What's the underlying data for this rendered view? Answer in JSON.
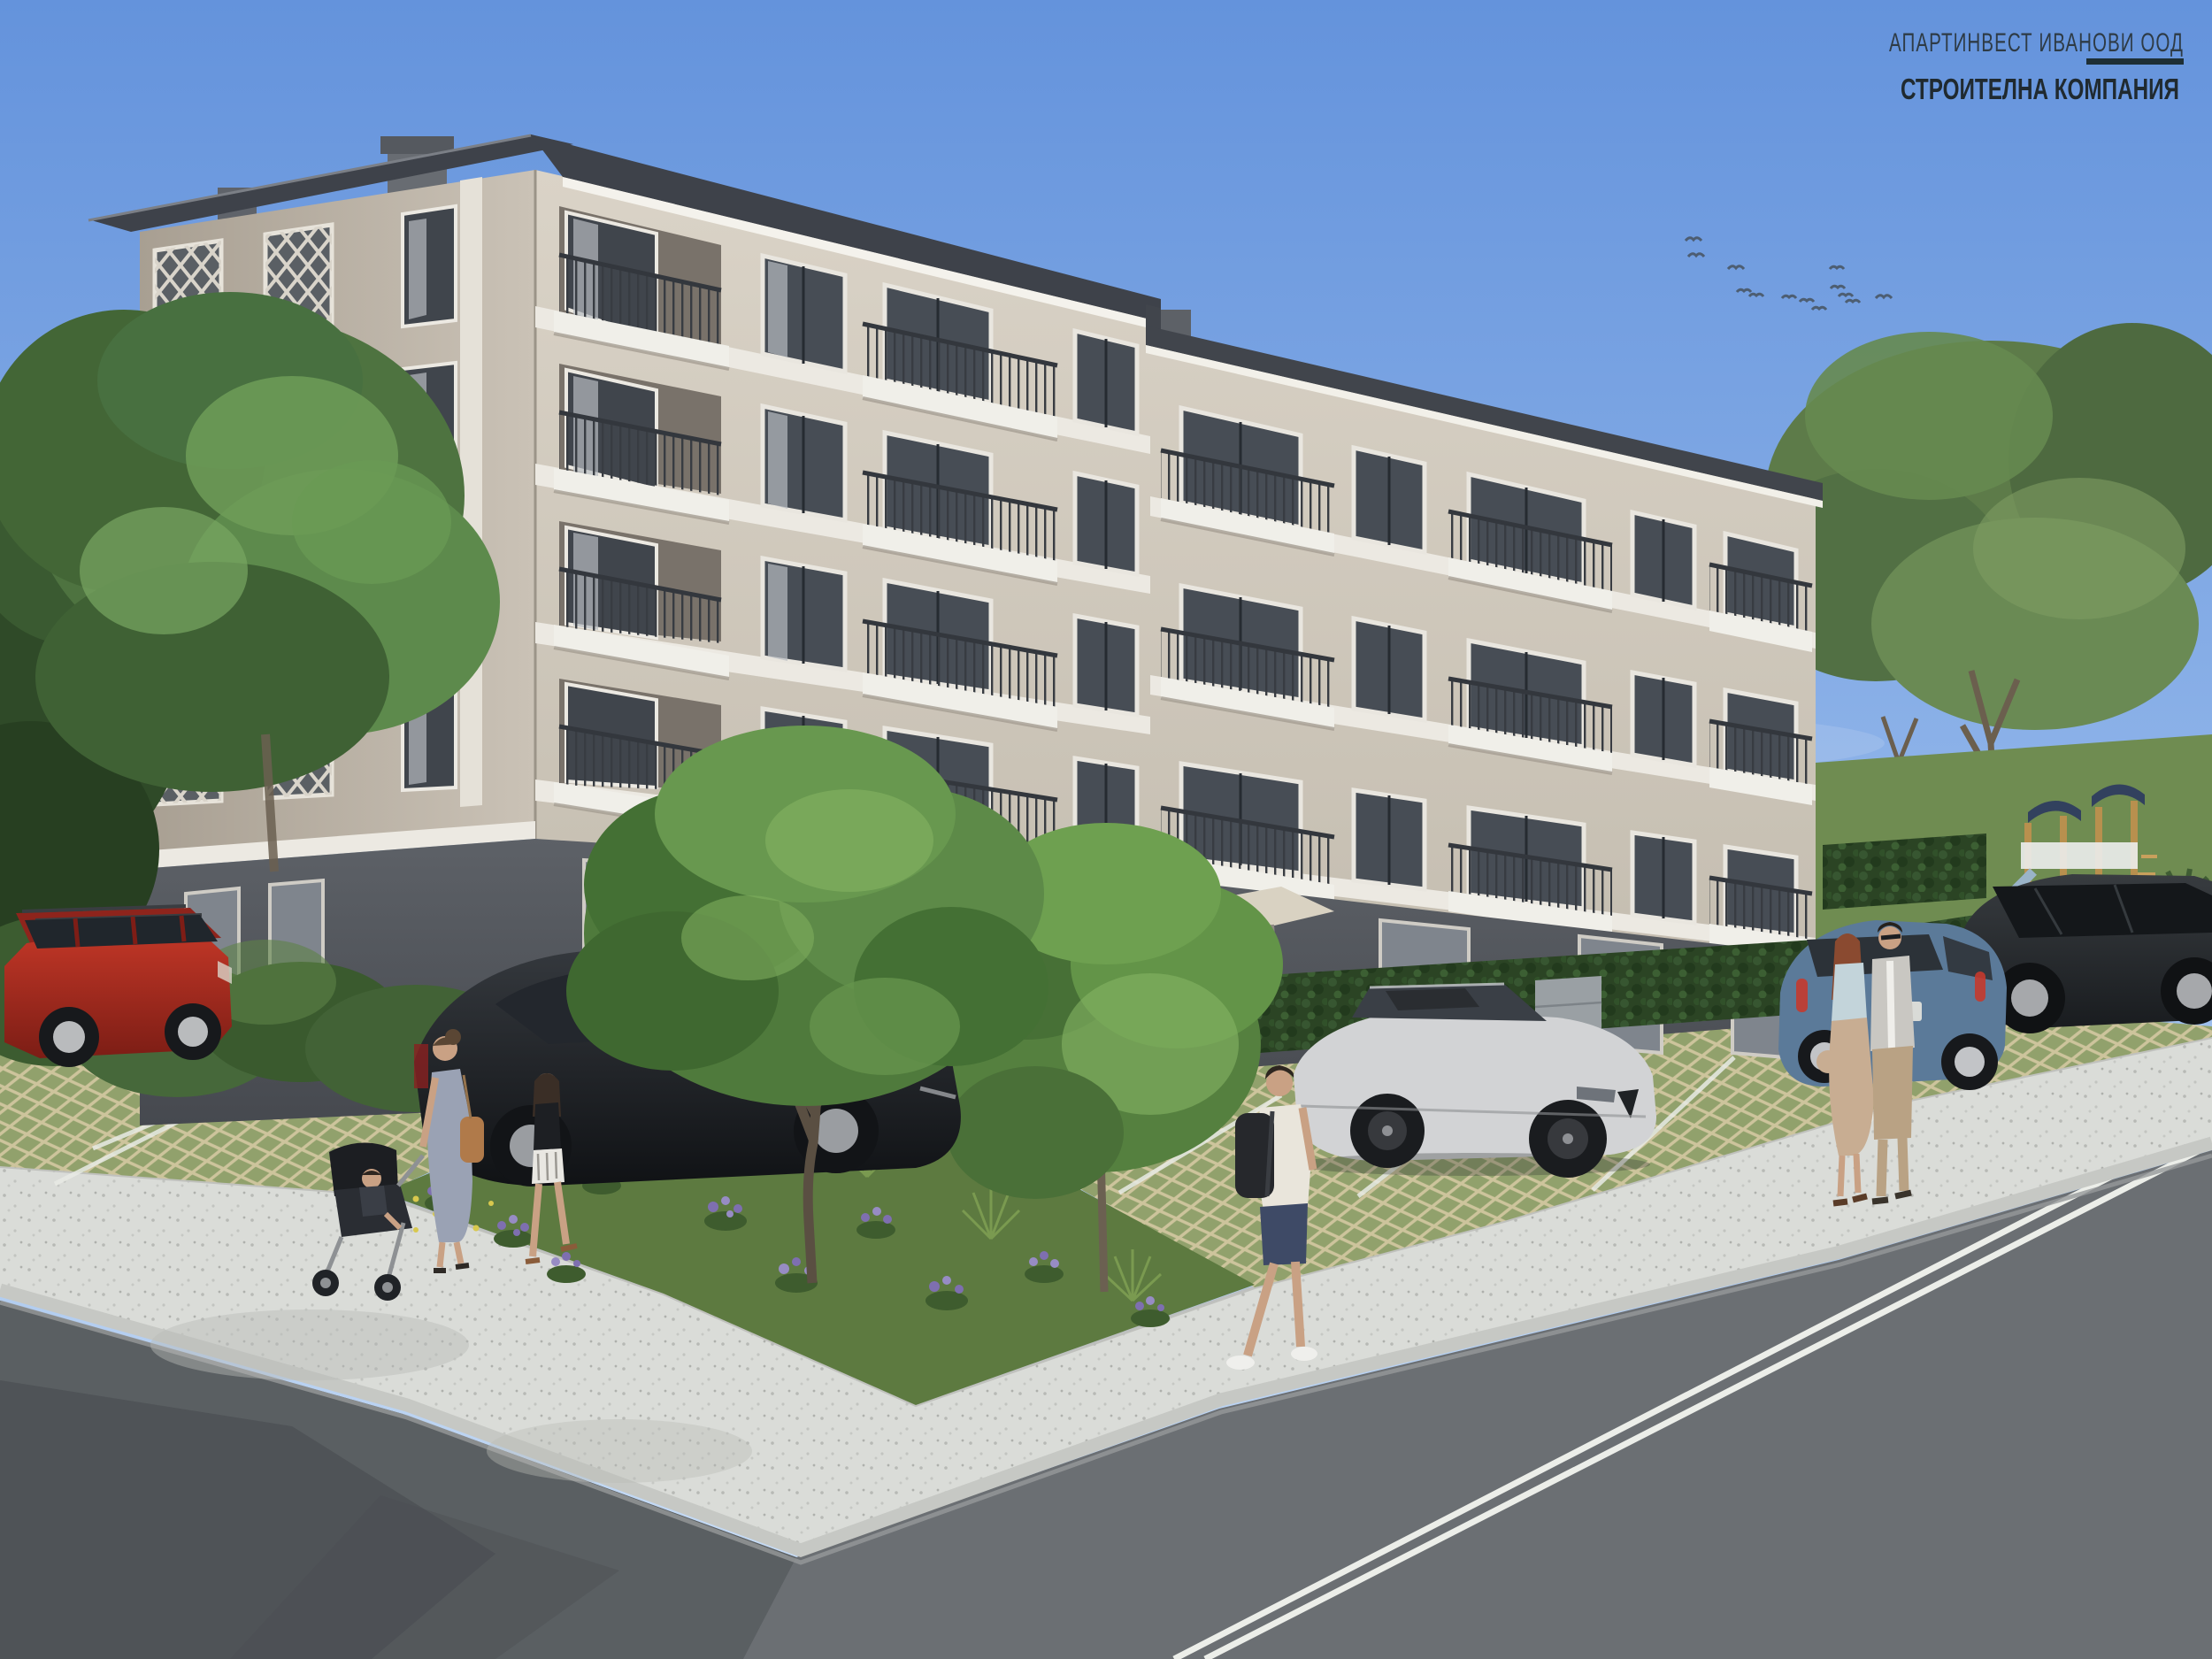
{
  "watermark": {
    "company_name": "АПАРТИНВЕСТ ИВАНОВИ ООД",
    "tagline": "СТРОИТЕЛНА КОМПАНИЯ",
    "name_color": "#2e3b46",
    "tagline_color": "#202a30",
    "divider_color": "#1e2f36"
  },
  "palette": {
    "sky_top": "#6493dc",
    "sky_mid": "#8fb4e9",
    "sky_horizon": "#cde0f6",
    "facade_cream_light": "#dad3c7",
    "facade_cream_dark": "#c7c0b3",
    "facade_band_white": "#ece9e2",
    "gable_greige": "#c2bab0",
    "roof_fascia_dark": "#3e424a",
    "ground_floor_dark": "#54585e",
    "railing_iron": "#383c42",
    "hedge_green": "#2b4424",
    "tree_green": "#55803f",
    "paver_green": "#91a16c",
    "paver_grid_beige": "#cdc49c",
    "sidewalk_gray": "#dadcd8",
    "asphalt_gray": "#6b6f73",
    "umbrella_beige": "#d9d2c2",
    "lavender_purple": "#7e6fb0",
    "red_suv": "#b02c20",
    "black_fastback": "#1f2227",
    "silver_sedan": "#d2d3d5",
    "blue_fiat": "#5b7a99",
    "dark_suv": "#2b2e32"
  }
}
